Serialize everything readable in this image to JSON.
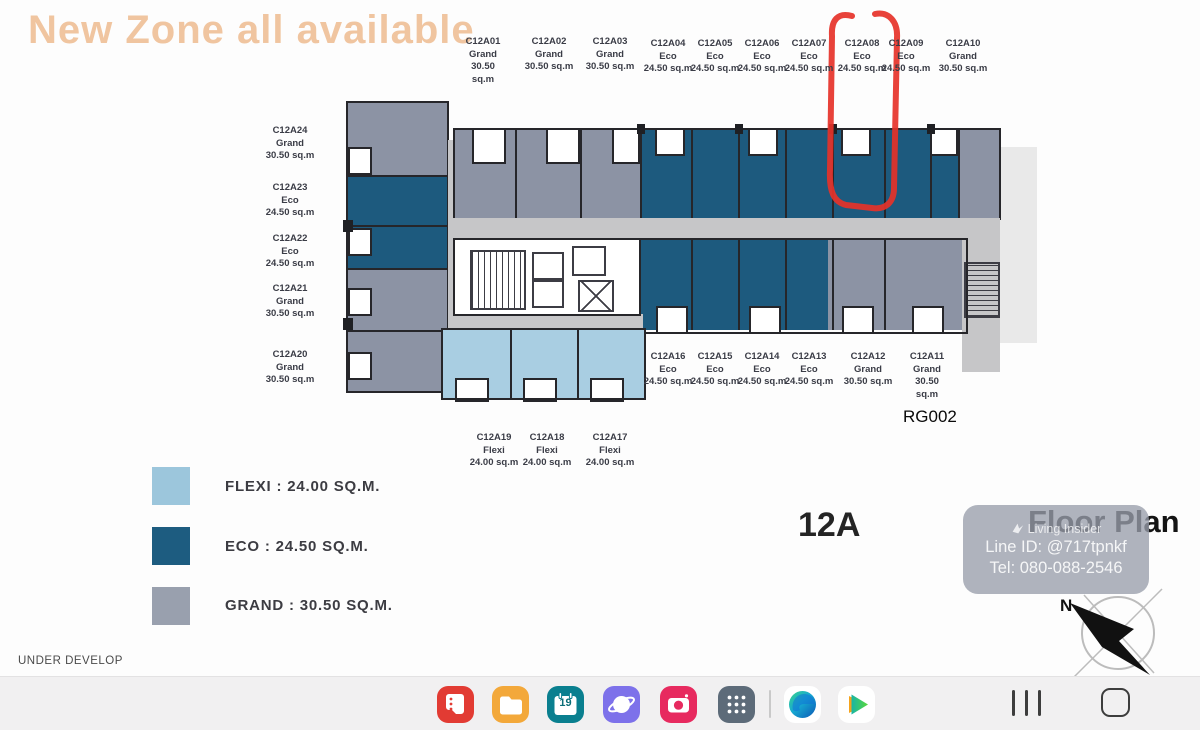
{
  "title": {
    "text": "New Zone all available",
    "color": "#f0c5a0"
  },
  "annotation": {
    "circled_unit": "C12A08",
    "shape": "hand-drawn-oval",
    "color": "#e63229"
  },
  "floor": {
    "number": "12A",
    "plan_title": "Floor Plan",
    "rg_code": "RG002",
    "under_develop": "UNDER DEVELOP",
    "north": "N"
  },
  "units": {
    "top_row": [
      {
        "name": "C12A01",
        "type": "Grand",
        "size": "30.50 sq.m"
      },
      {
        "name": "C12A02",
        "type": "Grand",
        "size": "30.50 sq.m"
      },
      {
        "name": "C12A03",
        "type": "Grand",
        "size": "30.50 sq.m"
      },
      {
        "name": "C12A04",
        "type": "Eco",
        "size": "24.50 sq.m"
      },
      {
        "name": "C12A05",
        "type": "Eco",
        "size": "24.50 sq.m"
      },
      {
        "name": "C12A06",
        "type": "Eco",
        "size": "24.50 sq.m"
      },
      {
        "name": "C12A07",
        "type": "Eco",
        "size": "24.50 sq.m"
      },
      {
        "name": "C12A08",
        "type": "Eco",
        "size": "24.50 sq.m"
      },
      {
        "name": "C12A09",
        "type": "Eco",
        "size": "24.50 sq.m"
      },
      {
        "name": "C12A10",
        "type": "Grand",
        "size": "30.50 sq.m"
      }
    ],
    "left_column": [
      {
        "name": "C12A24",
        "type": "Grand",
        "size": "30.50 sq.m"
      },
      {
        "name": "C12A23",
        "type": "Eco",
        "size": "24.50 sq.m"
      },
      {
        "name": "C12A22",
        "type": "Eco",
        "size": "24.50 sq.m"
      },
      {
        "name": "C12A21",
        "type": "Grand",
        "size": "30.50 sq.m"
      },
      {
        "name": "C12A20",
        "type": "Grand",
        "size": "30.50 sq.m"
      }
    ],
    "bottom_mid_row": [
      {
        "name": "C12A16",
        "type": "Eco",
        "size": "24.50 sq.m"
      },
      {
        "name": "C12A15",
        "type": "Eco",
        "size": "24.50 sq.m"
      },
      {
        "name": "C12A14",
        "type": "Eco",
        "size": "24.50 sq.m"
      },
      {
        "name": "C12A13",
        "type": "Eco",
        "size": "24.50 sq.m"
      },
      {
        "name": "C12A12",
        "type": "Grand",
        "size": "30.50 sq.m"
      },
      {
        "name": "C12A11",
        "type": "Grand",
        "size": "30.50 sq.m"
      }
    ],
    "bottom_row": [
      {
        "name": "C12A19",
        "type": "Flexi",
        "size": "24.00 sq.m"
      },
      {
        "name": "C12A18",
        "type": "Flexi",
        "size": "24.00 sq.m"
      },
      {
        "name": "C12A17",
        "type": "Flexi",
        "size": "24.00 sq.m"
      }
    ]
  },
  "legend": {
    "items": [
      {
        "label": "FLEXI : 24.00 SQ.M.",
        "color": "#9cc6dc"
      },
      {
        "label": "ECO : 24.50 SQ.M.",
        "color": "#1d5c80"
      },
      {
        "label": "GRAND : 30.50 SQ.M.",
        "color": "#99a0ae"
      }
    ]
  },
  "watermark": {
    "brand": "Living Insider",
    "line_id": "Line ID: @717tpnkf",
    "tel": "Tel: 080-088-2546"
  },
  "taskbar": {
    "calendar_day": "19",
    "apps": [
      "samsung-notes",
      "my-files",
      "calendar",
      "samsung-internet",
      "camera",
      "apps-grid",
      "edge",
      "wetv"
    ],
    "nav": [
      "recents",
      "home"
    ]
  },
  "colors": {
    "unit_gray": "#8c93a4",
    "unit_eco_blue": "#1d5a7e",
    "unit_flexi_blue": "#a9cee2",
    "corridor": "#c6c6c8",
    "wall": "#26262a",
    "annotation_red": "#e63229",
    "title_peach": "#f0c5a0",
    "taskbar_bg": "#f1f0f1"
  }
}
